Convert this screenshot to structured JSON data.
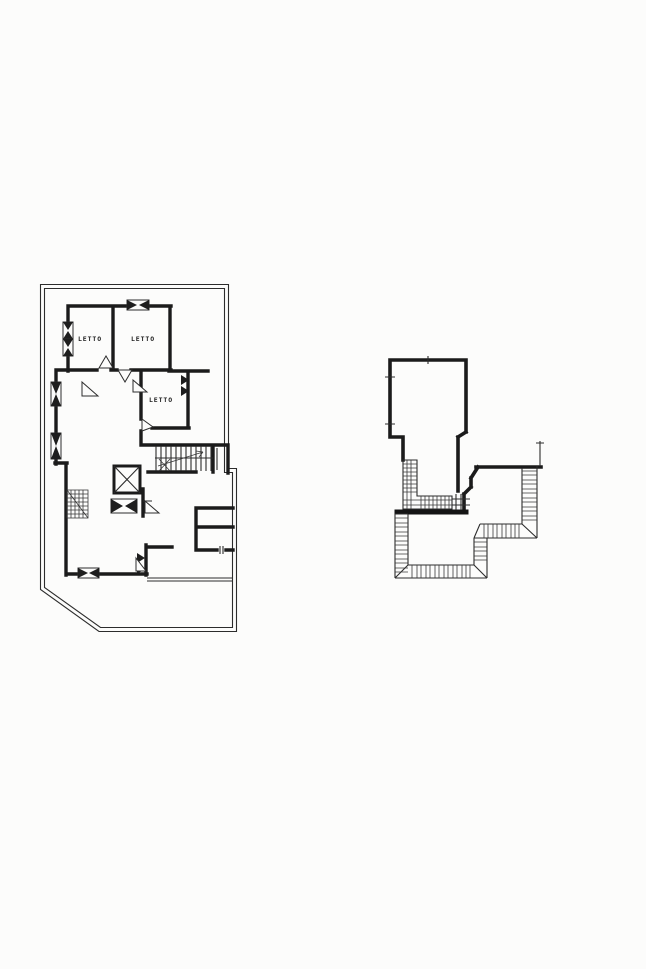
{
  "page": {
    "background_color": "#fcfcfb",
    "ink_color": "#1b1b1b"
  },
  "upper_floor_plan": {
    "semantic": "upper-floor-plan",
    "rooms": [
      {
        "label": "LETTO"
      },
      {
        "label": "LETTO"
      },
      {
        "label": "LETTO"
      }
    ],
    "symbols": [
      "staircase",
      "stair-direction-arrow",
      "elevator-x",
      "window-bowtie",
      "door-swing",
      "corner-steps",
      "lot-boundary",
      "terrace-divider"
    ]
  },
  "roof_plan": {
    "semantic": "roof-plan",
    "symbols": [
      "penthouse-walls",
      "stair-run-hatch",
      "roof-edge-hatch",
      "door-threshold",
      "chimney-pole"
    ]
  }
}
